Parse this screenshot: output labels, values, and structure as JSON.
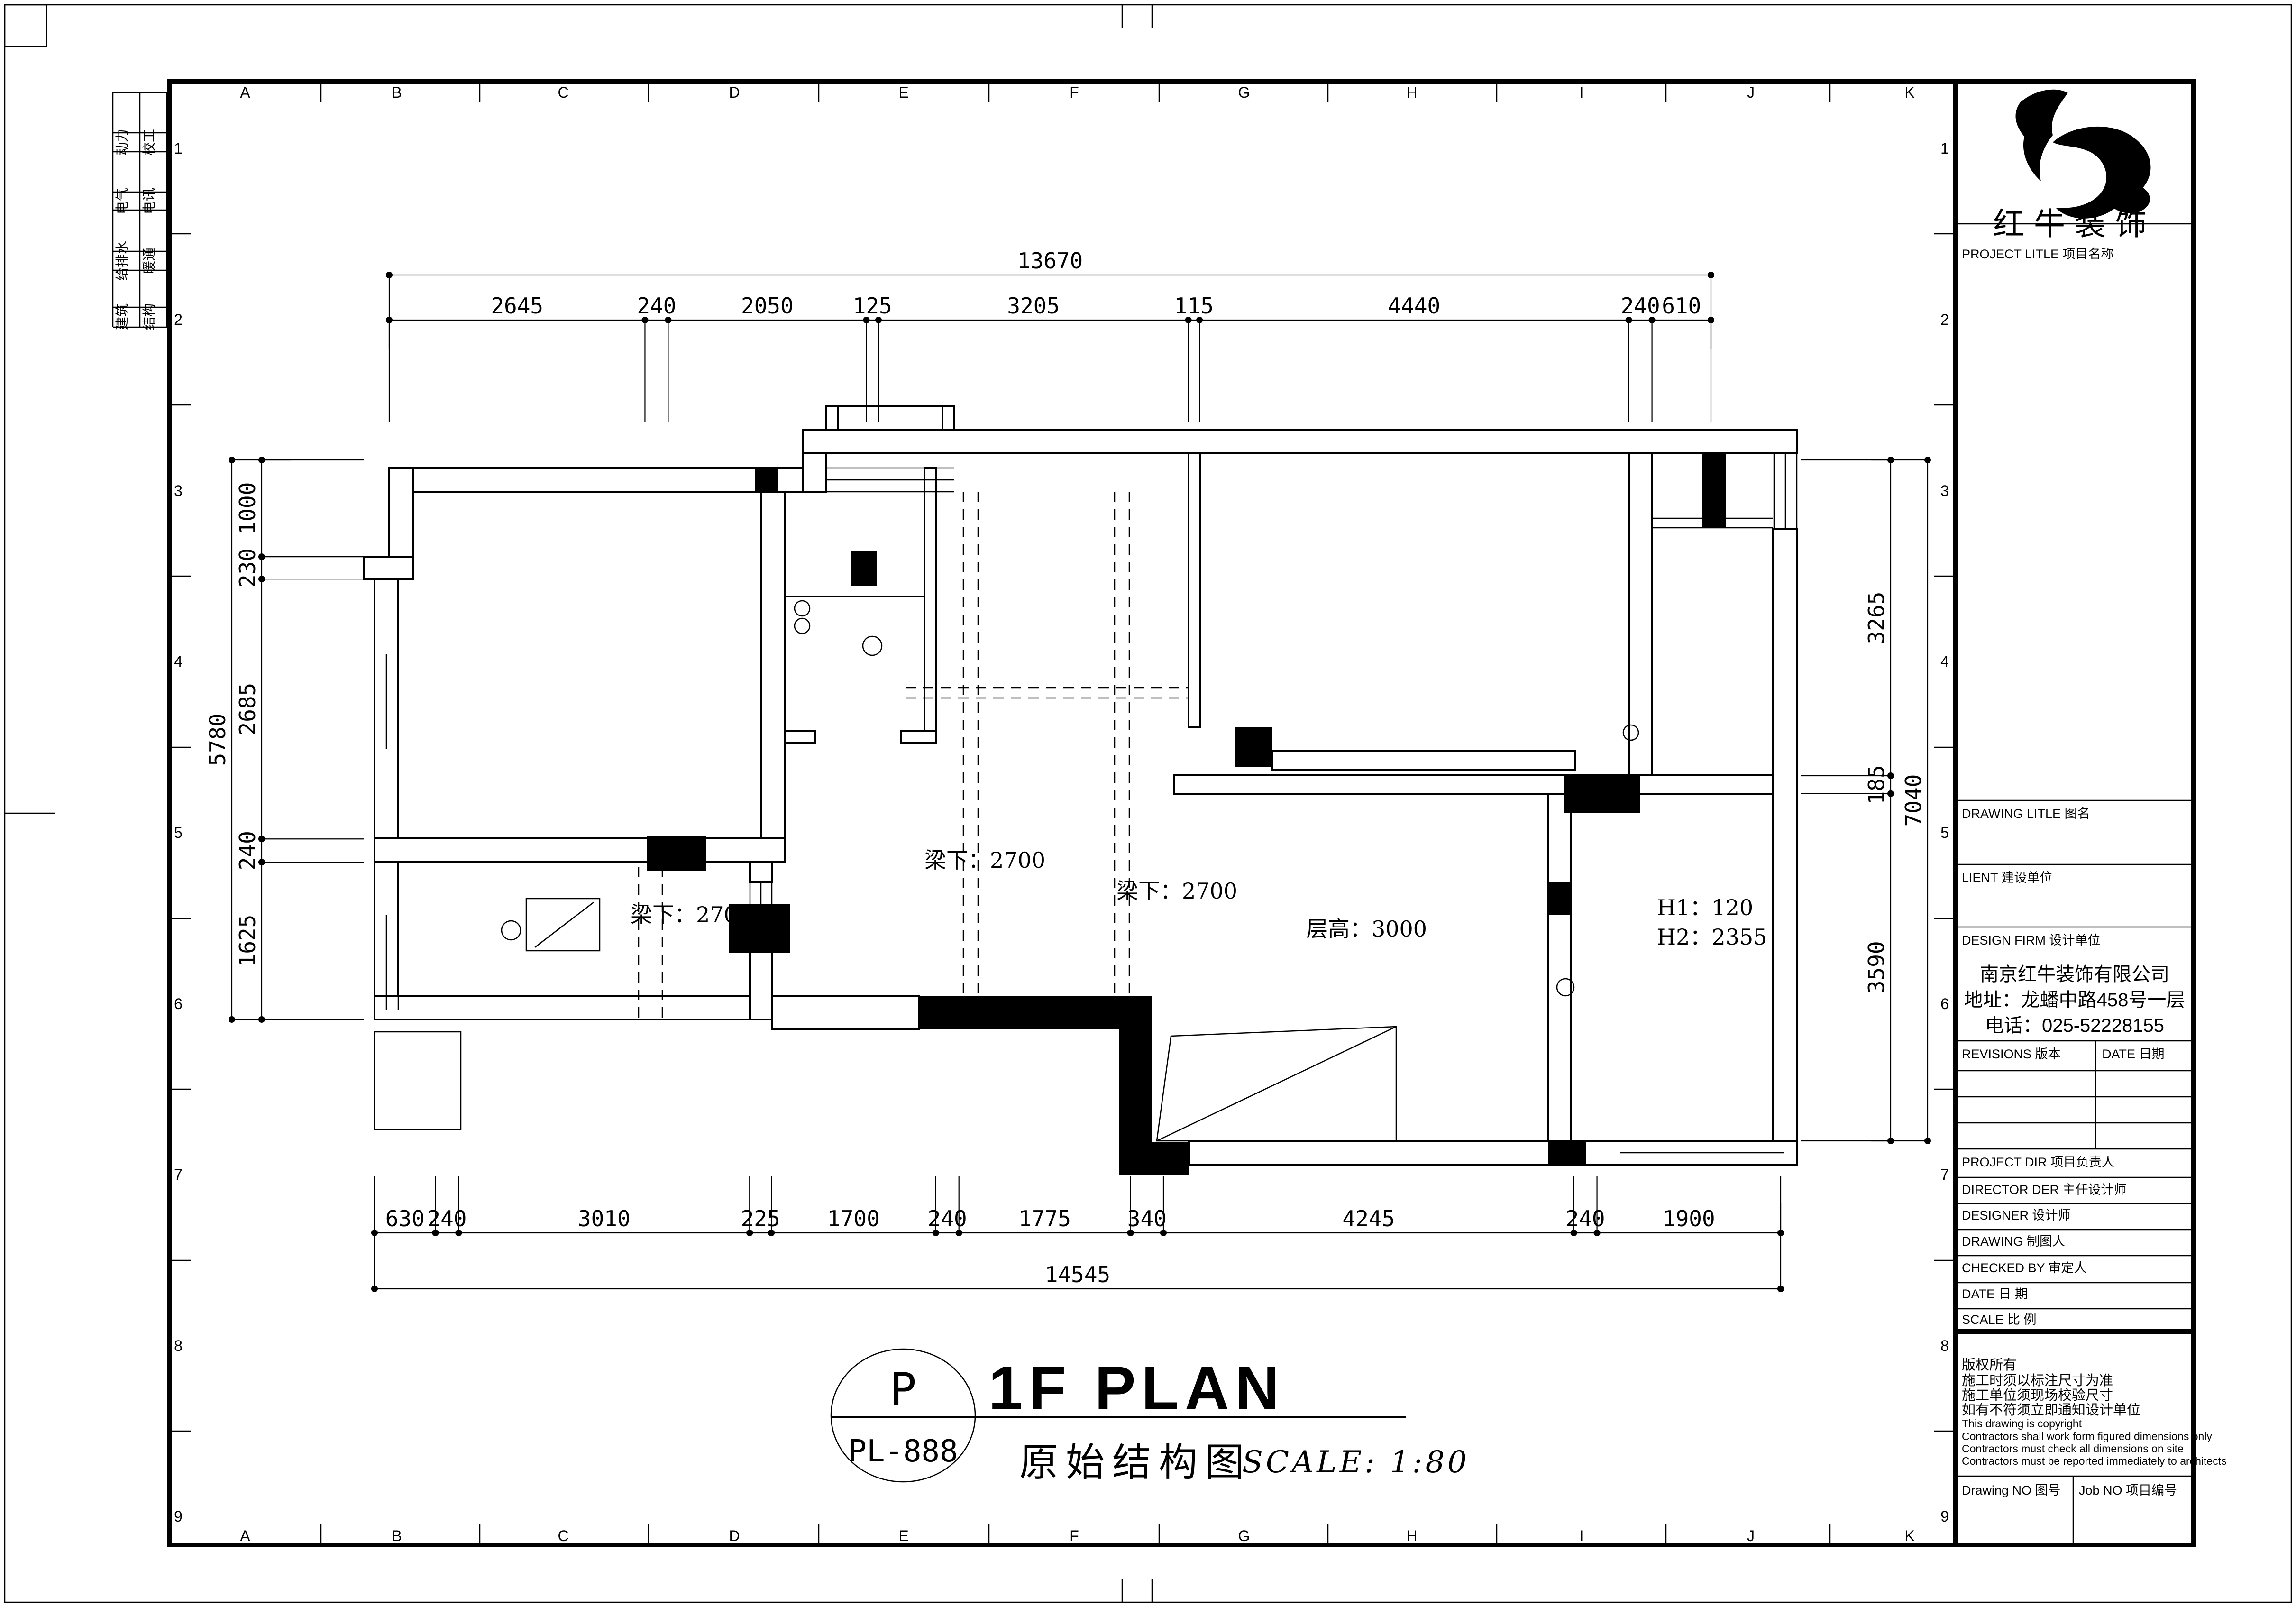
{
  "sheet": {
    "grid_letters": [
      "A",
      "B",
      "C",
      "D",
      "E",
      "F",
      "G",
      "H",
      "I",
      "J",
      "K"
    ],
    "grid_numbers": [
      "1",
      "2",
      "3",
      "4",
      "5",
      "6",
      "7",
      "8",
      "9"
    ]
  },
  "disciplines": [
    [
      "动力",
      "校工"
    ],
    [
      "电气",
      "电讯"
    ],
    [
      "给排水",
      "暖通"
    ],
    [
      "建筑",
      "结构"
    ]
  ],
  "title_block": {
    "brand": "红牛装饰",
    "project_title_label": "PROJECT LITLE  项目名称",
    "drawing_title_label": "DRAWING LITLE  图名",
    "client_label": "LIENT  建设单位",
    "design_firm_label": "DESIGN FIRM  设计单位",
    "company": [
      "南京红牛装饰有限公司",
      "地址：龙蟠中路458号一层",
      "电话：025-52228155"
    ],
    "revisions_label": "REVISIONS  版本",
    "date_col_label": "DATE  日期",
    "staff_rows": [
      "PROJECT DIR    项目负责人",
      "DIRECTOR DER  主任设计师",
      "DESIGNER         设计师",
      "DRAWING         制图人",
      "CHECKED BY     审定人",
      "DATE                日  期",
      "SCALE              比  例"
    ],
    "copyright": [
      "版权所有",
      "施工时须以标注尺寸为准",
      "施工单位须现场校验尺寸",
      "如有不符须立即通知设计单位",
      "This drawing is copyright",
      "Contractors shall work form figured dimensions only",
      "Contractors must check all dimensions on site",
      "Contractors must be reported immediately to architects"
    ],
    "drawing_no_label": "Drawing NO  图号",
    "job_no_label": "Job NO  项目编号"
  },
  "dimensions": {
    "top": {
      "total": "13670",
      "segments": [
        "2645",
        "240",
        "2050",
        "125",
        "3205",
        "115",
        "4440",
        "240",
        "610"
      ]
    },
    "bottom": {
      "total": "14545",
      "segments": [
        "630",
        "240",
        "3010",
        "225",
        "1700",
        "240",
        "1775",
        "340",
        "4245",
        "240",
        "1900"
      ]
    },
    "left": {
      "total": "5780",
      "segments": [
        "1000",
        "230",
        "2685",
        "240",
        "1625"
      ]
    },
    "right": {
      "total": "7040",
      "segments": [
        "3265",
        "185",
        "3590"
      ]
    }
  },
  "notes": {
    "beam": "梁下：2700",
    "floor_height": "层高：3000",
    "h1": "H1：120",
    "h2": "H2：2355"
  },
  "title": {
    "marker": "P",
    "code": "PL-888",
    "name_en": "1F PLAN",
    "name_cn": "原始结构图",
    "scale_label": "SCALE: 1:80"
  }
}
